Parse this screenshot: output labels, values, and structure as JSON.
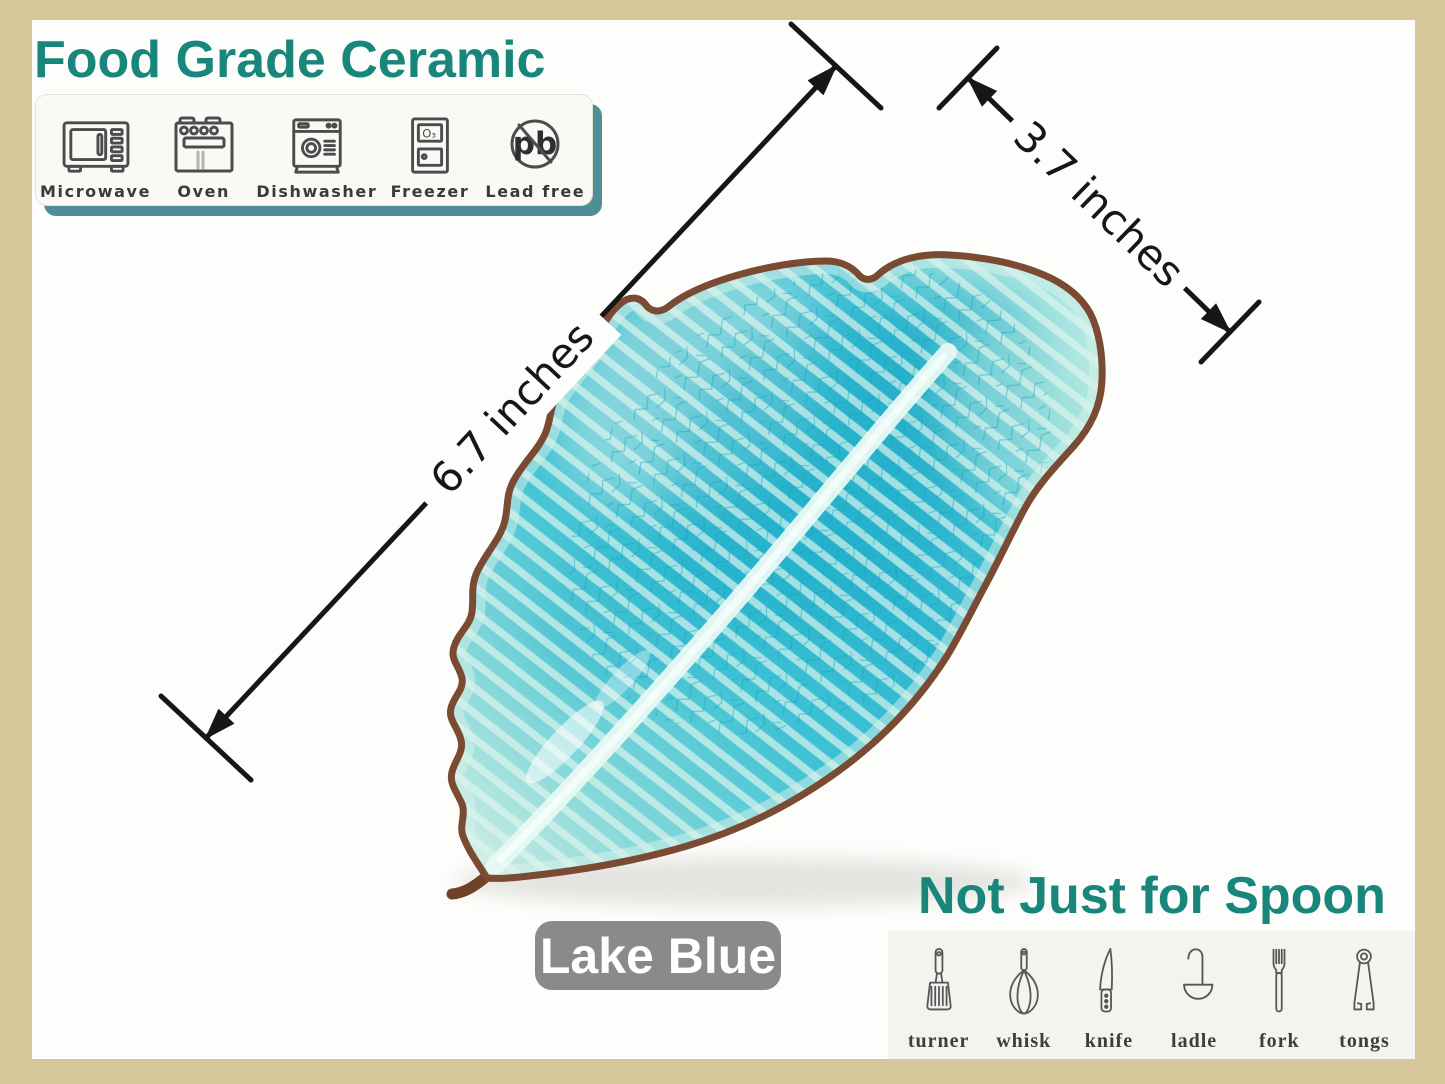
{
  "canvas": {
    "bg": "#fdfdfb",
    "frame_color": "#d6c79b"
  },
  "accent": {
    "teal": "#19867c",
    "bar_shadow": "#4f8e96",
    "dimension_line": "#161616"
  },
  "food_grade": {
    "title": "Food Grade Ceramic",
    "items": [
      {
        "label": "Microwave"
      },
      {
        "label": "Oven"
      },
      {
        "label": "Dishwasher"
      },
      {
        "label": "Freezer",
        "icon_text": "O₃"
      },
      {
        "label": "Lead free",
        "icon_text": "pb"
      }
    ]
  },
  "dimensions": {
    "length": "6.7 inches",
    "width": "3.7 inches"
  },
  "color_badge": {
    "label": "Lake Blue",
    "bg": "#8a8a8a"
  },
  "not_just_for_spoon": {
    "title": "Not Just for Spoon",
    "items": [
      {
        "label": "turner"
      },
      {
        "label": "whisk"
      },
      {
        "label": "knife"
      },
      {
        "label": "ladle"
      },
      {
        "label": "fork"
      },
      {
        "label": "tongs"
      }
    ]
  },
  "leaf": {
    "glaze": "#35bdd2",
    "glaze_light": "#cdeee6",
    "rim": "#7b4a33"
  }
}
